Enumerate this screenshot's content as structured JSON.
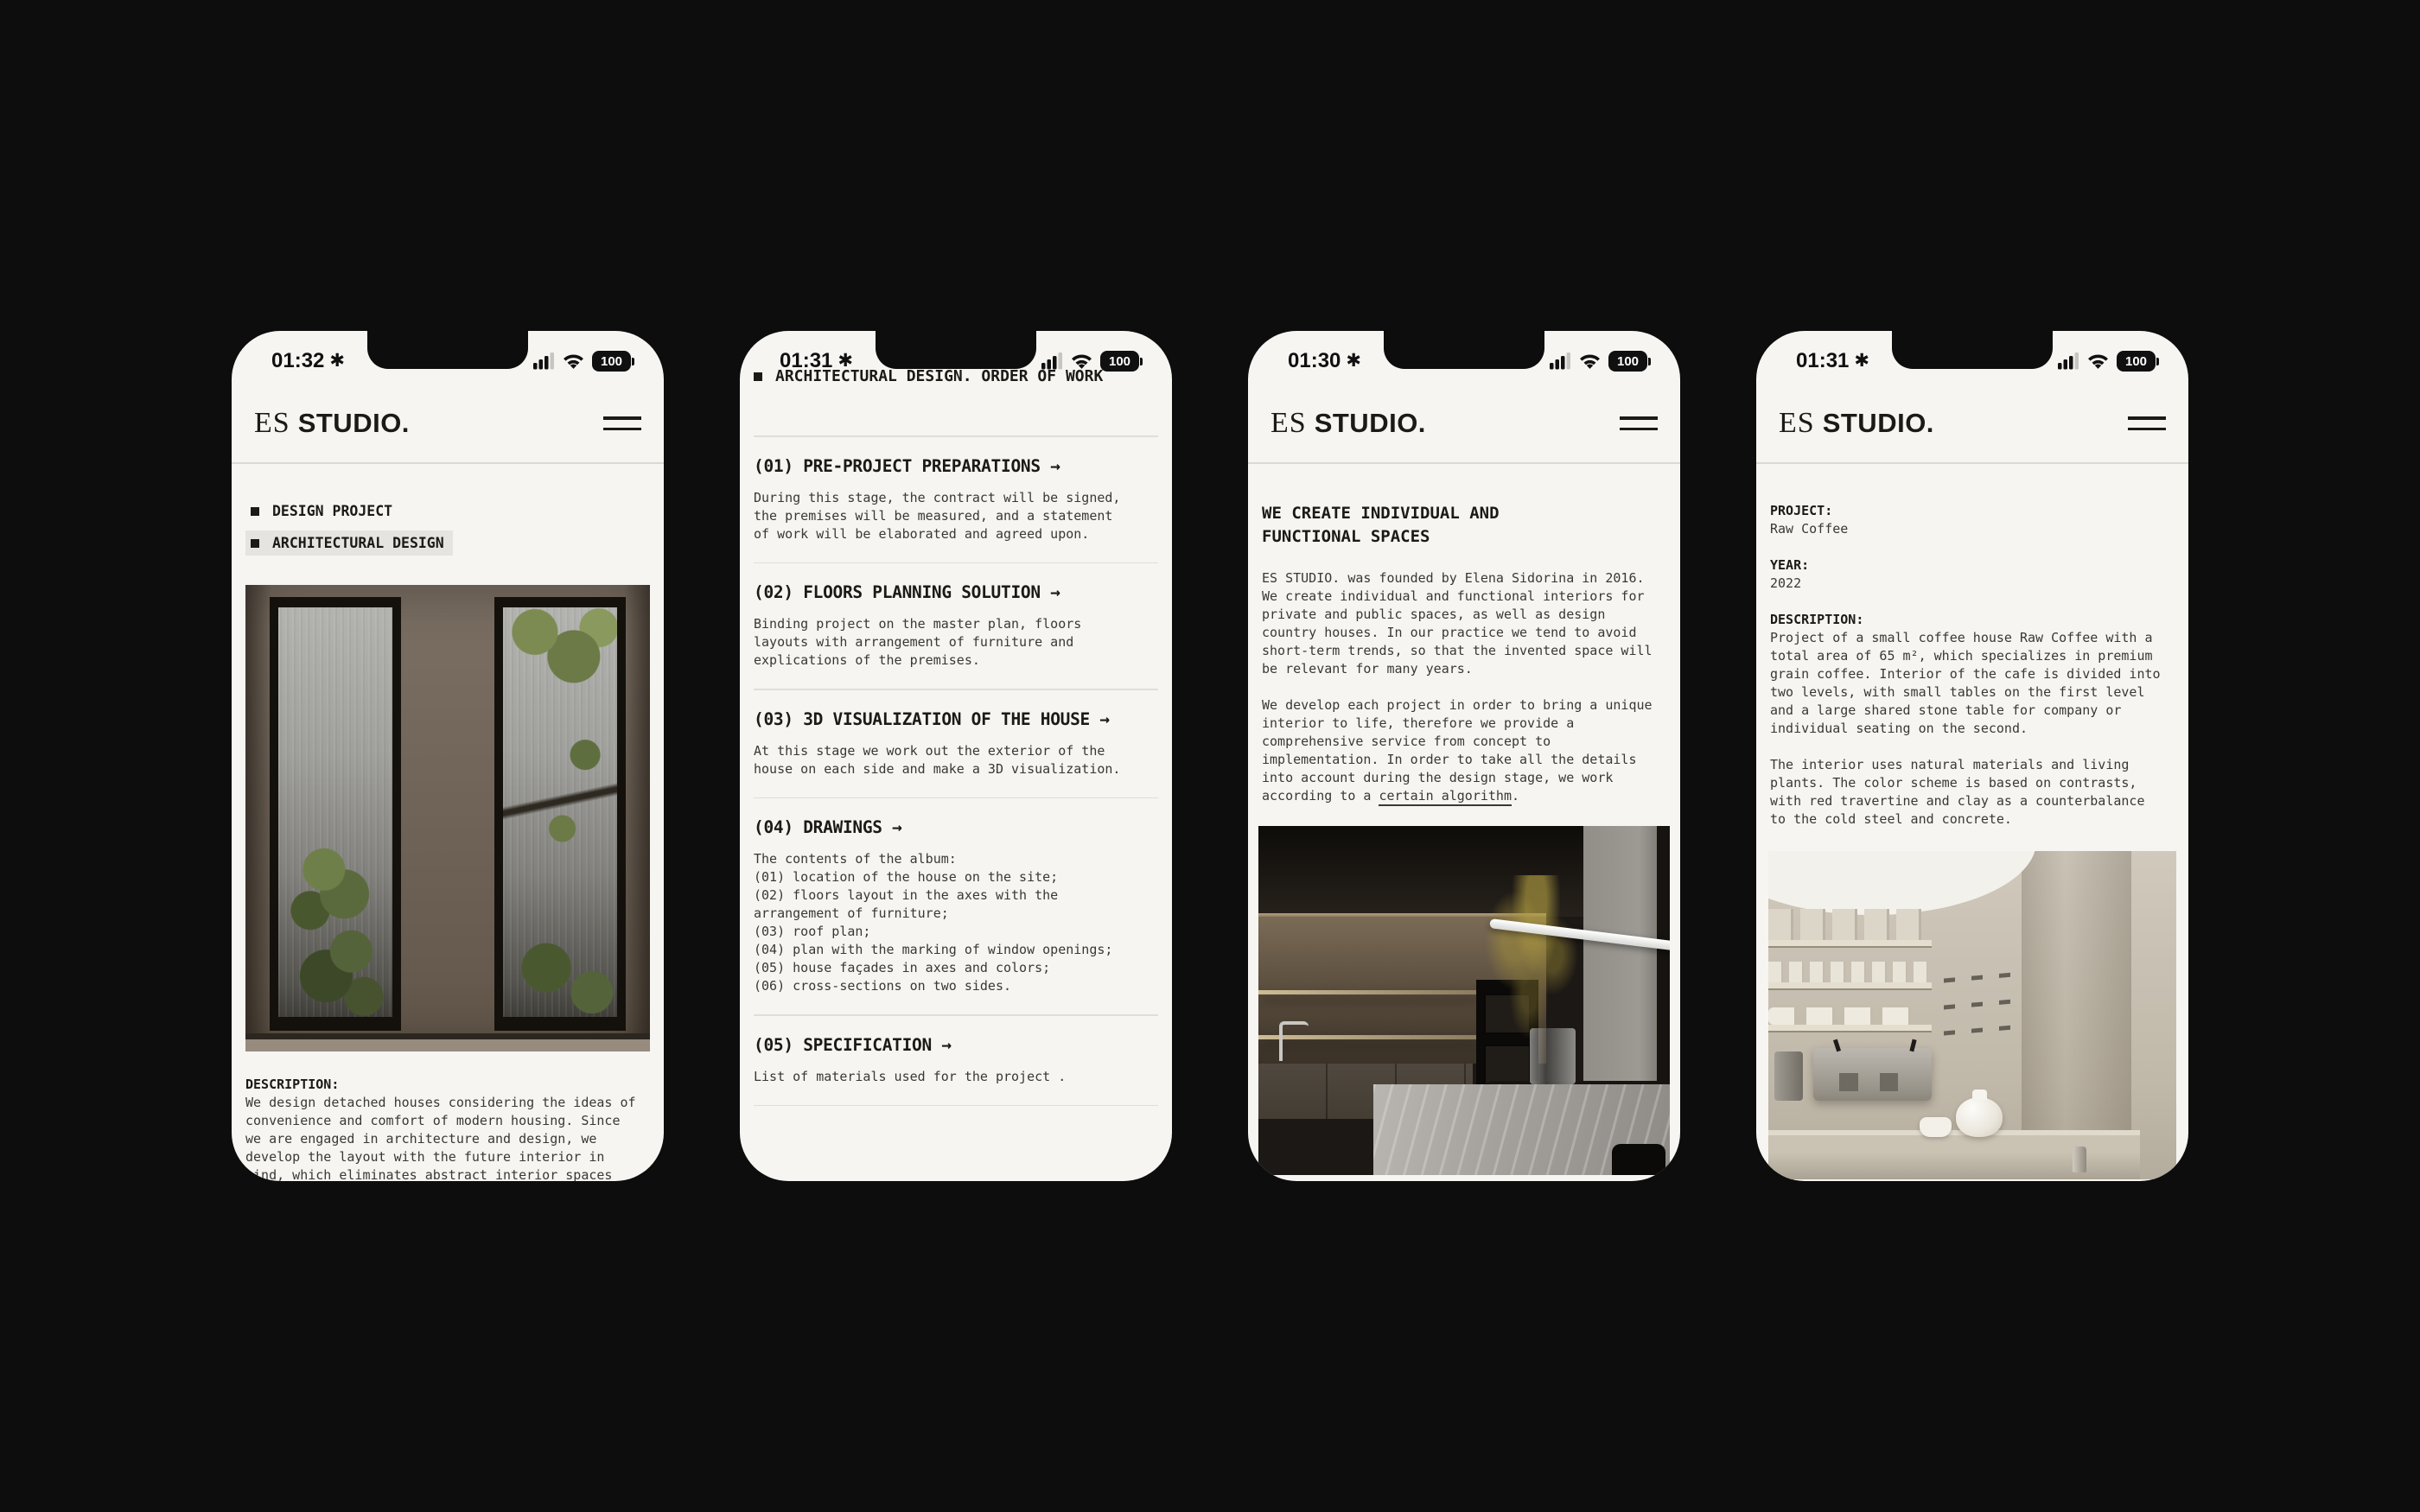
{
  "page": {
    "background": "#0d0d0d",
    "screen_color": "#f6f5f2",
    "accent_text": "#1b1a17",
    "divider": "#dbd9d4",
    "highlight": "#e6e4e0"
  },
  "brand": {
    "logo_es": "ES",
    "logo_studio": "STUDIO."
  },
  "status": {
    "battery_level": "100",
    "focus_glyph": "✱"
  },
  "phones": [
    {
      "time": "01:32",
      "menu": [
        {
          "label": "DESIGN PROJECT"
        },
        {
          "label": "ARCHITECTURAL DESIGN"
        }
      ],
      "description_label": "DESCRIPTION:",
      "description": "We design detached houses considering the ideas of\nconvenience and comfort of modern housing. Since\nwe are engaged in architecture and design, we\ndevelop the layout with the future interior in\nmind, which eliminates abstract interior spaces"
    },
    {
      "time": "01:31",
      "title": "ARCHITECTURAL DESIGN. ORDER OF WORK",
      "sections": [
        {
          "title": "(01) PRE-PROJECT PREPARATIONS →",
          "body": "During this stage, the contract will be signed,\nthe premises will be measured, and a statement\nof work will be elaborated and agreed upon."
        },
        {
          "title": "(02) FLOORS PLANNING SOLUTION →",
          "body": "Binding project on the master plan, floors\nlayouts with arrangement of furniture and\nexplications of the premises."
        },
        {
          "title": "(03) 3D VISUALIZATION OF THE HOUSE →",
          "body": "At this stage we work out the exterior of the\nhouse on each side and make a 3D visualization."
        },
        {
          "title": "(04) DRAWINGS →",
          "body": "The contents of the album:\n(01) location of the house on the site;\n(02) floors layout in the axes with the\narrangement of furniture;\n(03) roof plan;\n(04) plan with the marking of window openings;\n(05) house façades in axes and colors;\n(06) cross-sections on two sides."
        },
        {
          "title": "(05) SPECIFICATION →",
          "body": "List of materials used for the project ."
        }
      ]
    },
    {
      "time": "01:30",
      "title": "WE CREATE INDIVIDUAL AND\nFUNCTIONAL SPACES",
      "para1": "ES STUDIO. was founded by Elena Sidorina in 2016.\nWe create individual and functional interiors for\nprivate and public spaces, as well as design\ncountry houses. In our practice we tend to avoid\nshort-term trends, so that the invented space will\nbe relevant for many years.",
      "para2_before": "We develop each project in order to bring a unique\ninterior to life, therefore we provide a\ncomprehensive service from concept to\nimplementation. In order to take all the details\ninto account during the design stage, we work\naccording to a ",
      "para2_link": "certain algorithm",
      "para2_after": "."
    },
    {
      "time": "01:31",
      "project_label": "PROJECT:",
      "project_value": "Raw Coffee",
      "year_label": "YEAR:",
      "year_value": "2022",
      "description_label": "DESCRIPTION:",
      "description_1": "Project of a small coffee house Raw Coffee with a\ntotal area of 65 m², which specializes in premium\ngrain coffee. Interior of the cafe is divided into\ntwo levels, with small tables on the first level\nand a large shared stone table for company or\nindividual seating on the second.",
      "description_2": "The interior uses natural materials and living\nplants. The color scheme is based on contrasts,\nwith red travertine and clay as a counterbalance\nto the cold steel and concrete."
    }
  ]
}
